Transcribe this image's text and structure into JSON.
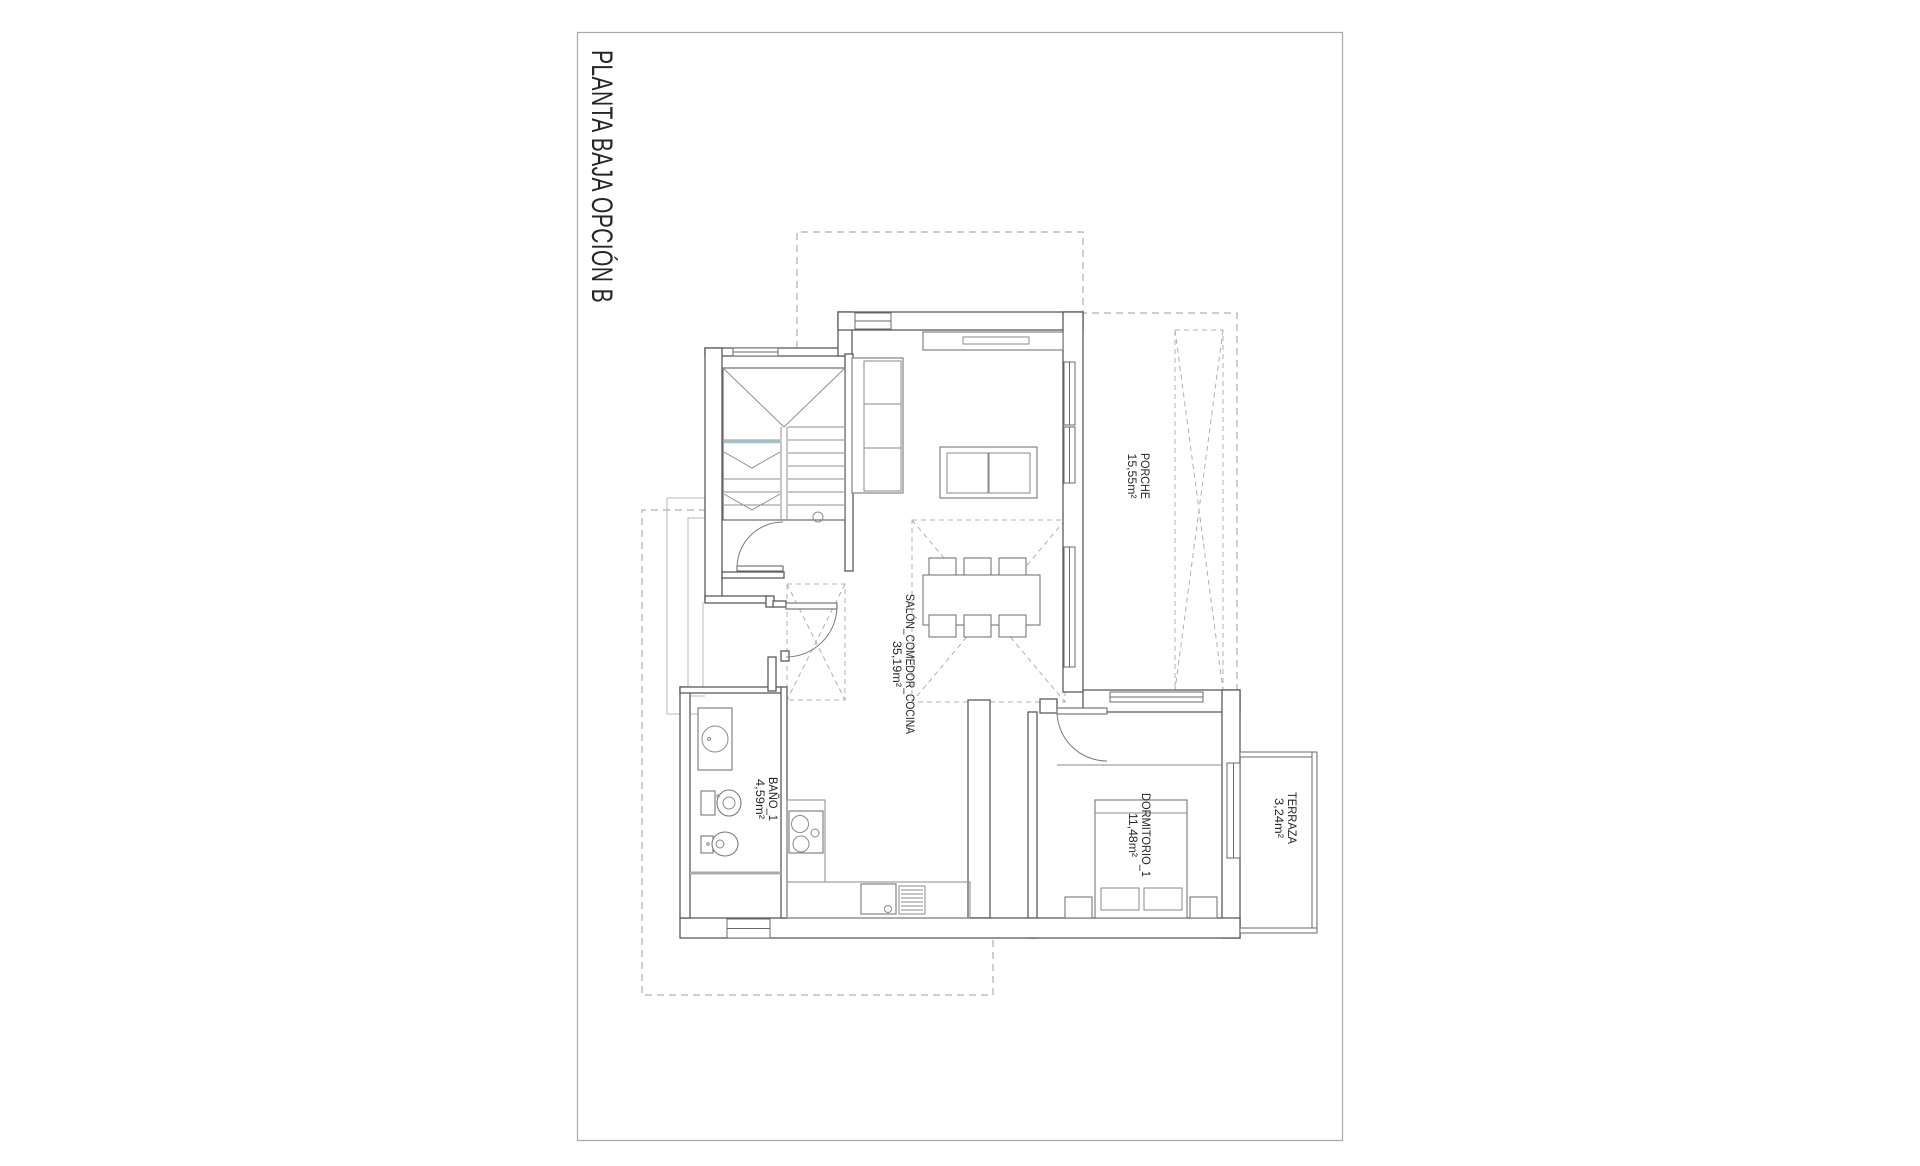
{
  "page": {
    "title": "PLANTA BAJA OPCIÓN B"
  },
  "rooms": {
    "porche": {
      "name": "PORCHE",
      "area": "15,55m²"
    },
    "salon": {
      "name": "SALÓN_COMEDOR_COCINA",
      "area": "35,19m²"
    },
    "bano": {
      "name": "BAÑO_1",
      "area": "4,59m²"
    },
    "dormitorio": {
      "name": "DORMITORIO_1",
      "area": "11,48m²"
    },
    "terraza": {
      "name": "TERRAZA",
      "area": "3,24m²"
    }
  },
  "colors": {
    "wall_line": "#5a5a5a",
    "dashed_line": "#9d9d9d",
    "stair_section_blue": "#9cc3d5",
    "page_border": "#a8a8a8",
    "text": "#262626",
    "background": "#ffffff"
  }
}
